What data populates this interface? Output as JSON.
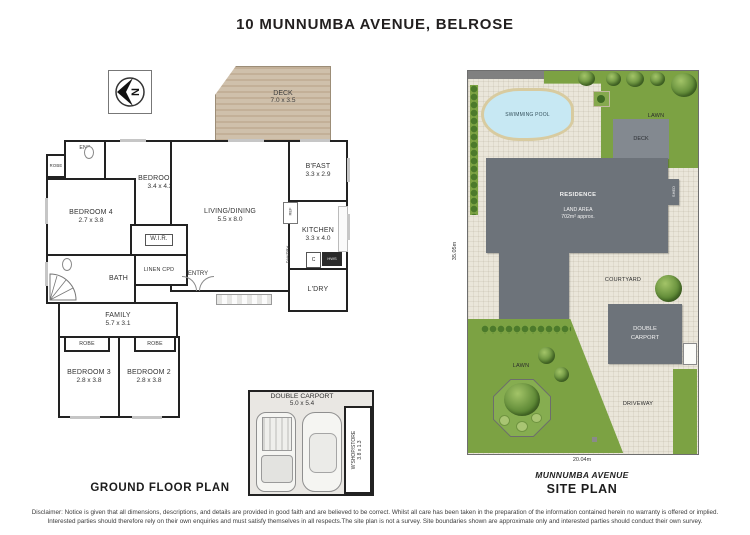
{
  "title": "10 MUNNUMBA AVENUE, BELROSE",
  "floor_plan": {
    "caption": "GROUND FLOOR PLAN",
    "compass_letter": "N",
    "deck": {
      "name": "DECK",
      "dims": "7.0 x 3.5"
    },
    "rooms": {
      "bed1": {
        "name": "BEDROOM 1",
        "dims": "3.4 x 4.3"
      },
      "bed2": {
        "name": "BEDROOM 2",
        "dims": "2.8 x 3.8"
      },
      "bed3": {
        "name": "BEDROOM 3",
        "dims": "2.8 x 3.8"
      },
      "bed4": {
        "name": "BEDROOM 4",
        "dims": "2.7 x 3.8"
      },
      "living": {
        "name": "LIVING/DINING",
        "dims": "5.5 x 8.0"
      },
      "family": {
        "name": "FAMILY",
        "dims": "5.7 x 3.1"
      },
      "bfast": {
        "name": "B'FAST",
        "dims": "3.3 x 2.9"
      },
      "kitchen": {
        "name": "KITCHEN",
        "dims": "3.3 x 4.0"
      },
      "bath": {
        "name": "BATH"
      },
      "ens": {
        "name": "ENS"
      },
      "wir": {
        "name": "W.I.R."
      },
      "linen": {
        "name": "LINEN CPD"
      },
      "entry": {
        "name": "ENTRY"
      },
      "ldry": {
        "name": "L'DRY"
      },
      "pantry": {
        "name": "PANTRY"
      },
      "ref": {
        "name": "REF"
      },
      "robe": {
        "name": "ROBE"
      },
      "cupd": {
        "name": "C"
      },
      "hws": {
        "name": "HWS"
      }
    },
    "carport": {
      "name": "DOUBLE CARPORT",
      "dims": "5.0 x 5.4",
      "store_name": "W'SHOP/STORE",
      "store_dims": "3.8 x 1.3"
    }
  },
  "site_plan": {
    "caption": "SITE PLAN",
    "street_label": "MUNNUMBA AVENUE",
    "width_dim": "20.04m",
    "depth_dim": "35.05m",
    "pool": "SWIMMING POOL",
    "lawn_top": "LAWN",
    "lawn_bottom": "LAWN",
    "deck": "DECK",
    "residence": "RESIDENCE",
    "land_area_label": "LAND AREA",
    "land_area_value": "702m² approx.",
    "courtyard": "COURTYARD",
    "carport": "DOUBLE CARPORT",
    "driveway": "DRIVEWAY",
    "shed": "SHED"
  },
  "disclaimer": {
    "line1": "Disclaimer: Notice is given that all dimensions, descriptions, and details are provided in good faith and are believed to be correct. Whilst all care has been taken in the preparation of the information contained herein no warranty is offered or implied.",
    "line2": "Interested parties should therefore rely on their own enquiries and must satisfy themselves in all respects.The site plan is not a survey. Site boundaries shown are approximate only and interested parties should conduct their own survey."
  },
  "colors": {
    "wall": "#222222",
    "building_grey": "#6d737a",
    "lawn_green": "#7ca243",
    "hedge_green": "#4c7a2b",
    "paving": "#eae6da",
    "pool_blue": "#c7e8f3",
    "pool_border": "#d8cba0",
    "deck_timber": "#c9b8a1"
  }
}
